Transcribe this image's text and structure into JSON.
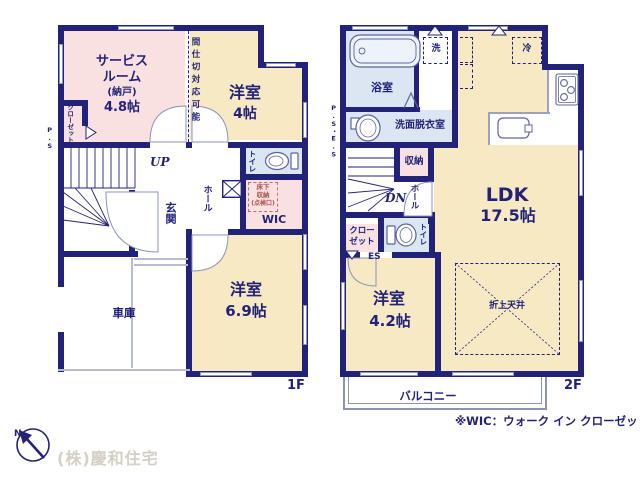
{
  "colors": {
    "wall": "#232279",
    "room_cream": "#f6e9c4",
    "room_pink": "#f8e1e0",
    "room_blue": "#dbe6f2",
    "window_line": "#8b93bb",
    "logo_gray": "#d5d0c6"
  },
  "company": "(株)慶和住宅",
  "north": "N",
  "wic_note": "※WIC：ウォーク イン クローゼット",
  "floor1": {
    "label": "1F",
    "service_room": {
      "name1": "サービス",
      "name2": "ルーム",
      "sub": "(納戸)",
      "size": "4.8帖"
    },
    "partition_note": "間仕切対応可能",
    "closet": "クローゼット",
    "ps": "P.S",
    "bedroom4": {
      "name": "洋室",
      "size": "4帖"
    },
    "stairs_up": "UP",
    "hall": "ホール",
    "entrance": "玄関",
    "toilet": "トイレ",
    "underfloor": {
      "line1": "床下",
      "line2": "収納",
      "line3": "(点検口)"
    },
    "wic": "WIC",
    "bedroom69": {
      "name": "洋室",
      "size": "6.9帖"
    },
    "garage": "車庫"
  },
  "floor2": {
    "label": "2F",
    "bath": "浴室",
    "washer": "洗",
    "washroom": "洗面脱衣室",
    "ps_es": "P.S・E.S",
    "fridge": "冷",
    "storage": "収納",
    "stairs_down": "DN",
    "hall": "ホール",
    "closet1": "クロー",
    "closet2": "ゼット",
    "toilet": "トイレ",
    "es": "ES",
    "ldk": {
      "name": "LDK",
      "size": "17.5帖"
    },
    "bedroom42": {
      "name": "洋室",
      "size": "4.2帖"
    },
    "ceiling": "折上天井",
    "balcony": "バルコニー"
  }
}
